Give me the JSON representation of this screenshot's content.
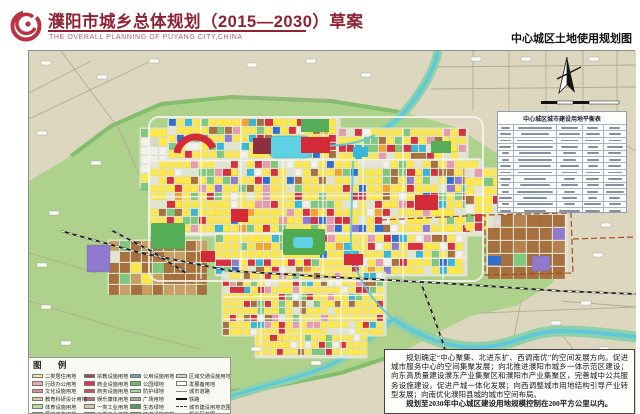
{
  "header": {
    "title": "濮阳市城乡总体规划（2015—2030）草案",
    "subtitle": "THE OVERALL PLANNING OF PUYANG CITY,CHINA",
    "map_label": "中心城区土地使用规划图",
    "title_color": "#8e2233",
    "logo_icon": "puyang-planning-emblem"
  },
  "map": {
    "balance_table_title": "中心城区城市建设用地平衡表",
    "compass_icon": "north-arrow",
    "scale_bar_icon": "scale-bar",
    "water_color": "#5ec9dc",
    "field_color": "#aed18c",
    "rural_color": "#ddd7bf"
  },
  "legend": {
    "title": "图  例",
    "columns": [
      {
        "items": [
          {
            "label": "二类居住用地",
            "color": "#f0e98e",
            "type": "fill"
          },
          {
            "label": "行政办公用地",
            "color": "#e9a7b6",
            "type": "fill"
          },
          {
            "label": "文化设施用地",
            "color": "#dd8aa2",
            "type": "fill"
          },
          {
            "label": "教育科研设计用地",
            "color": "#ddcf9e",
            "type": "fill"
          },
          {
            "label": "体育设施用地",
            "color": "#b5e09b",
            "type": "fill"
          },
          {
            "label": "医疗卫生用地",
            "color": "#e2899a",
            "type": "fill"
          }
        ]
      },
      {
        "items": [
          {
            "label": "宗教设施用地",
            "color": "#9c4a58",
            "type": "fill"
          },
          {
            "label": "商业设施用地",
            "color": "#e0314e",
            "type": "fill"
          },
          {
            "label": "商务设施用地",
            "color": "#c85064",
            "type": "fill"
          },
          {
            "label": "娱乐康体用地",
            "color": "#c06a7a",
            "type": "fill"
          },
          {
            "label": "一类工业用地",
            "color": "#d8c8a0",
            "type": "fill"
          },
          {
            "label": "二类工业用地",
            "color": "#a87848",
            "type": "fill"
          }
        ]
      },
      {
        "items": [
          {
            "label": "公用设施用地",
            "color": "#6fa3b8",
            "type": "fill"
          },
          {
            "label": "公园绿地",
            "color": "#6fbf6f",
            "type": "fill"
          },
          {
            "label": "防护绿地",
            "color": "#a5d89c",
            "type": "fill"
          },
          {
            "label": "广场用地",
            "color": "#9fae9f",
            "type": "fill"
          },
          {
            "label": "生态绿地",
            "color": "#4e9a58",
            "type": "fill"
          },
          {
            "label": "环卫设施用地",
            "color": "#eef0e8",
            "type": "fill"
          }
        ]
      },
      {
        "items": [
          {
            "label": "区域交通设施用地",
            "color": "#cfcfcf",
            "type": "fill"
          },
          {
            "label": "发展备用地",
            "color": "#ffffff",
            "type": "fill"
          },
          {
            "label": "城市道路",
            "color": "#888888",
            "type": "line"
          },
          {
            "label": "铁路",
            "color": "#222222",
            "type": "rail"
          },
          {
            "label": "城市建设用地范围",
            "color": "#444444",
            "type": "dash"
          },
          {
            "label": "规划区范围",
            "color": "#b03a2a",
            "type": "dashdot"
          }
        ]
      }
    ]
  },
  "notes": {
    "para1": "规划确定“中心聚集、北进东扩、西调南优”的空间发展方向。促进城市服务中心的空间集聚发展；向北推进濮阳市城乡一体示范区建设；向东高质量建设濮东产业集聚区和濮阳市产业集聚区，完善城中公共服务设施建设，促进产城一体化发展；向西调整城市用地结构引导产业转型发展；向南优化濮阳县城的城市空间布局。",
    "para2": "规划至2030年中心城区建设用地规模控制在200平方公里以内。"
  }
}
